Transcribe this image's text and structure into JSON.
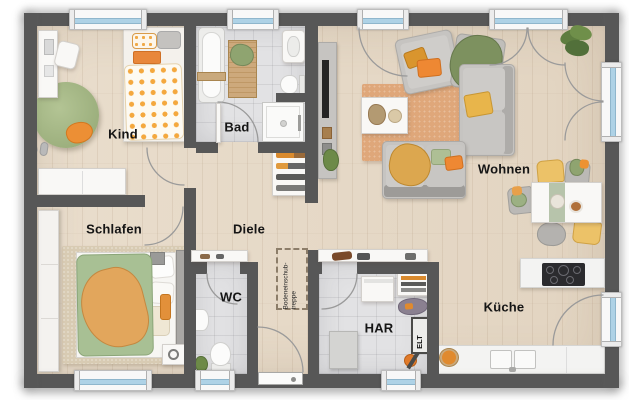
{
  "plan": {
    "type": "floor-plan",
    "rooms": [
      {
        "id": "kind",
        "label": "Kind"
      },
      {
        "id": "bad",
        "label": "Bad"
      },
      {
        "id": "wohnen",
        "label": "Wohnen"
      },
      {
        "id": "schlafen",
        "label": "Schlafen"
      },
      {
        "id": "diele",
        "label": "Diele"
      },
      {
        "id": "wc",
        "label": "WC"
      },
      {
        "id": "har",
        "label": "HAR"
      },
      {
        "id": "kueche",
        "label": "Küche"
      }
    ],
    "annotations": {
      "attic_stairs_line1": "Bodeneinschub-",
      "attic_stairs_line2": "treppe",
      "electrical_panel": "ELT"
    },
    "theme": {
      "wall": "#575757",
      "frame": "#f8f8f8",
      "glass": "#aed2e6",
      "arc": "#9a9a9a",
      "label": "#151515",
      "orange": "#ec9233",
      "yellow": "#ecc268",
      "sage": "#b7c4ab",
      "green": "#8fa470",
      "terracotta": "#e0a87c"
    }
  }
}
